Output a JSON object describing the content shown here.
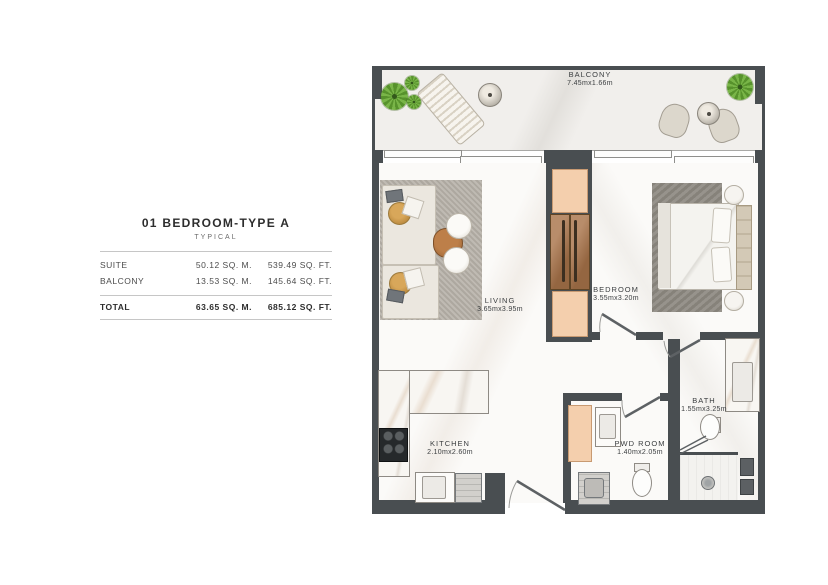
{
  "info_panel": {
    "title": "01 BEDROOM-TYPE A",
    "subtitle": "TYPICAL",
    "columns": [
      "AREA",
      "SQ. M.",
      "SQ. FT."
    ],
    "rows": [
      {
        "label": "SUITE",
        "sqm": "50.12 SQ. M.",
        "sqft": "539.49 SQ. FT."
      },
      {
        "label": "BALCONY",
        "sqm": "13.53 SQ. M.",
        "sqft": "145.64 SQ. FT."
      }
    ],
    "total": {
      "label": "TOTAL",
      "sqm": "63.65 SQ. M.",
      "sqft": "685.12 SQ. FT."
    }
  },
  "rooms": {
    "balcony": {
      "name": "BALCONY",
      "dims": "7.45mx1.66m"
    },
    "living": {
      "name": "LIVING",
      "dims": "3.65mx3.95m"
    },
    "bedroom": {
      "name": "BEDROOM",
      "dims": "3.55mx3.20m"
    },
    "kitchen": {
      "name": "KITCHEN",
      "dims": "2.10mx2.60m"
    },
    "bath": {
      "name": "BATH",
      "dims": "1.55mx3.25m"
    },
    "pwd": {
      "name": "PWD ROOM",
      "dims": "1.40mx2.05m"
    }
  },
  "colors": {
    "wall": "#494e51",
    "closet_peach": "#f4cfad",
    "wardrobe_wood": "#a9744a",
    "plant_green": "#6aa63b",
    "rug_gray": "#b6b1a8",
    "text": "#3b3e40"
  }
}
